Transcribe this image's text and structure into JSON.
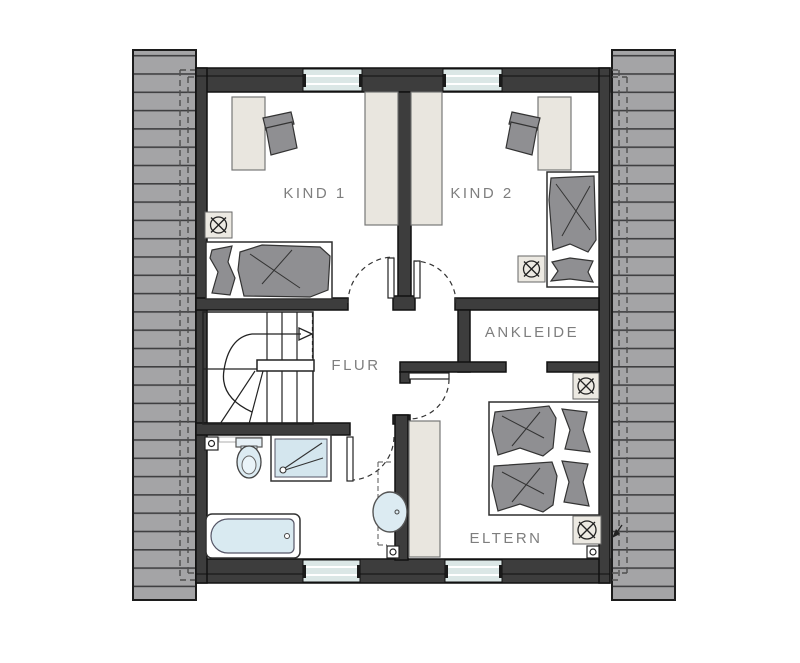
{
  "plan": {
    "type": "floor-plan",
    "language": "de",
    "rooms": [
      {
        "id": "kind1",
        "label": "KIND 1"
      },
      {
        "id": "kind2",
        "label": "KIND 2"
      },
      {
        "id": "ankleide",
        "label": "ANKLEIDE"
      },
      {
        "id": "flur",
        "label": "FLUR"
      },
      {
        "id": "eltern",
        "label": "ELTERN"
      }
    ],
    "fixtures": [
      "desk-kind1",
      "chair-kind1",
      "bed-kind1",
      "vent-symbol-kind1",
      "wardrobe-kind1",
      "wardrobe-kind2",
      "desk-kind2",
      "chair-kind2",
      "bed-kind2",
      "vent-symbol-kind2",
      "stairs-with-winders",
      "walking-line-arrow",
      "toilet",
      "shower",
      "bathtub",
      "washbasin",
      "wardrobe-eltern",
      "double-bed-eltern",
      "vent-symbol-ankleide",
      "vent-symbol-eltern"
    ],
    "doors": [
      "door-kind1",
      "door-kind2",
      "door-eltern",
      "door-bath"
    ],
    "windows_count": 4,
    "colors": {
      "wall": "#3d3d3d",
      "wall_outline": "#111111",
      "roof": "#a4a4a6",
      "roof_line": "#3f3f41",
      "window_glass": "#dbe7e6",
      "furniture_gray": "#8f8f92",
      "furniture_cream": "#e9e6df",
      "sanitary_blue": "#d6e8f0",
      "label_gray": "#7e7e7e",
      "background": "#ffffff"
    }
  }
}
